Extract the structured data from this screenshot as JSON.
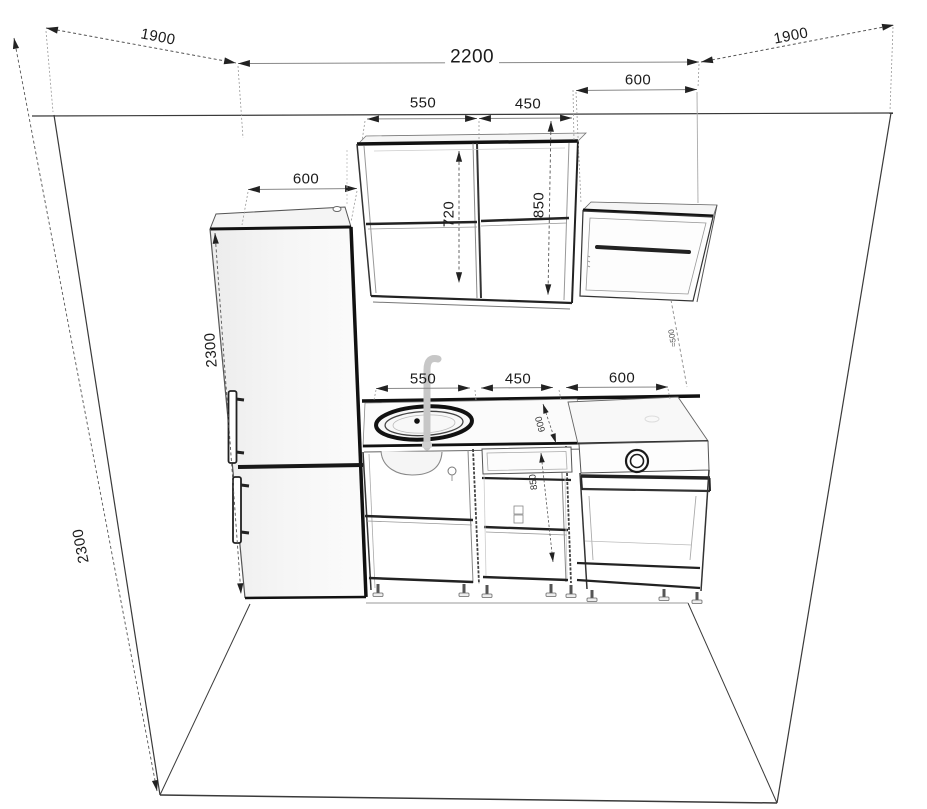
{
  "drawing": {
    "type": "kitchen-elevation-perspective",
    "dims": {
      "top_left_depth": "1900",
      "top_width": "2200",
      "top_right_depth": "1900",
      "hood_width": "600",
      "wall_cabinet_1_width": "550",
      "wall_cabinet_2_width": "450",
      "fridge_width": "600",
      "fridge_height": "2300",
      "left_wall_height": "2300",
      "wall_cabinet_1_height": "720",
      "wall_cabinet_2_height": "850",
      "base_sink_width": "550",
      "base_mid_width": "450",
      "base_stove_width": "600",
      "counter_depth": "600",
      "counter_height": "850",
      "hood_clearance": "≈500"
    }
  }
}
